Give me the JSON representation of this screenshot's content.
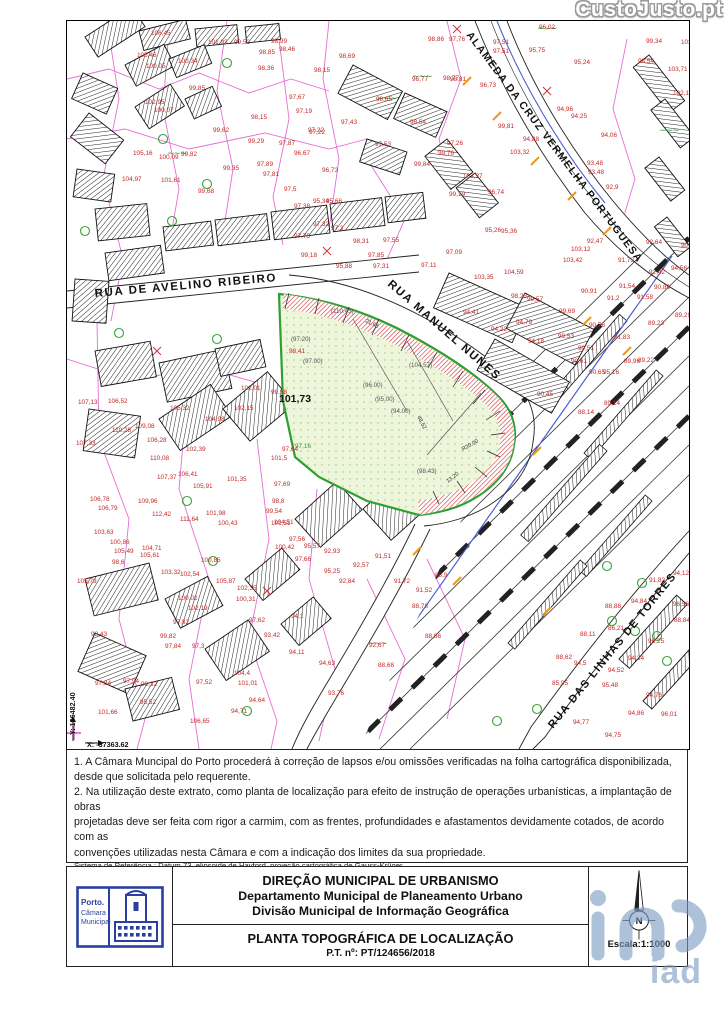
{
  "watermarks": {
    "top": "CustoJusto.pt",
    "bottom": "iad"
  },
  "map": {
    "streets": [
      {
        "label": "RUA DE AVELINO RIBEIRO",
        "x": 28,
        "y": 276,
        "rot": -5,
        "fs": 11.5,
        "ls": 1.6
      },
      {
        "label": "RUA MANUEL NUNES",
        "x": 320,
        "y": 264,
        "rot": 41,
        "fs": 11.5,
        "ls": 1.6
      },
      {
        "label": "ALAMEDA DA CRUZ VERMELHA PORTUGUESA",
        "x": 399,
        "y": 14,
        "rot": 53,
        "fs": 10.5,
        "ls": 1.3
      },
      {
        "label": "RUA DAS LINHAS DE TORRES",
        "x": 486,
        "y": 708,
        "rot": -51,
        "fs": 11,
        "ls": 1.5
      }
    ],
    "corner": {
      "y_label": "Y: 166482.40",
      "x_label": "X: -37363.62"
    },
    "parcel_labels": [
      {
        "x": 264,
        "y": 292,
        "v": "(110.43)",
        "c": "dim"
      },
      {
        "x": 224,
        "y": 320,
        "v": "(97.20)",
        "c": "dim"
      },
      {
        "x": 236,
        "y": 342,
        "v": "(97.00)",
        "c": "dim"
      },
      {
        "x": 296,
        "y": 366,
        "v": "(96.00)",
        "c": "dim"
      },
      {
        "x": 308,
        "y": 380,
        "v": "(95.00)",
        "c": "dim"
      },
      {
        "x": 324,
        "y": 392,
        "v": "(94.00)",
        "c": "dim"
      },
      {
        "x": 342,
        "y": 346,
        "v": "(104.57)",
        "c": "dim"
      },
      {
        "x": 212,
        "y": 381,
        "v": "101,73",
        "c": "bold"
      },
      {
        "x": 228,
        "y": 427,
        "v": "97,16",
        "c": "green"
      },
      {
        "x": 350,
        "y": 452,
        "v": "(98.43)",
        "c": "dim"
      }
    ],
    "dims": [
      {
        "x": 298,
        "y": 301,
        "v": "21.65",
        "rot": 26
      },
      {
        "x": 350,
        "y": 396,
        "v": "48.52",
        "rot": 62
      },
      {
        "x": 381,
        "y": 462,
        "v": "13.20",
        "rot": -38
      },
      {
        "x": 396,
        "y": 430,
        "v": "R20.00",
        "rot": -30
      }
    ],
    "points": [
      [
        84,
        14,
        "106,45"
      ],
      [
        70,
        36,
        "105,46"
      ],
      [
        79,
        47,
        "100,05"
      ],
      [
        111,
        42,
        "100,34"
      ],
      [
        141,
        23,
        "101,93"
      ],
      [
        167,
        23,
        "99,52"
      ],
      [
        204,
        22,
        "98,99"
      ],
      [
        212,
        30,
        "98,46"
      ],
      [
        192,
        33,
        "98,85"
      ],
      [
        272,
        37,
        "98,69"
      ],
      [
        247,
        51,
        "98,15"
      ],
      [
        191,
        49,
        "98,36"
      ],
      [
        122,
        69,
        "99,85"
      ],
      [
        222,
        78,
        "97,67"
      ],
      [
        229,
        92,
        "97,19"
      ],
      [
        274,
        103,
        "97,43"
      ],
      [
        241,
        111,
        "97,22"
      ],
      [
        184,
        98,
        "98,15"
      ],
      [
        146,
        111,
        "99,62"
      ],
      [
        181,
        122,
        "99,29"
      ],
      [
        212,
        124,
        "97,87"
      ],
      [
        227,
        134,
        "96,67"
      ],
      [
        66,
        134,
        "105,16"
      ],
      [
        92,
        138,
        "100,09"
      ],
      [
        114,
        135,
        "99,82"
      ],
      [
        156,
        149,
        "99,35"
      ],
      [
        190,
        145,
        "97,89"
      ],
      [
        196,
        155,
        "97,81"
      ],
      [
        255,
        151,
        "96,73"
      ],
      [
        55,
        160,
        "104,97"
      ],
      [
        94,
        161,
        "101,61"
      ],
      [
        131,
        172,
        "99,68"
      ],
      [
        217,
        170,
        "97,5"
      ],
      [
        78,
        83,
        "102,95"
      ],
      [
        87,
        91,
        "100,07"
      ],
      [
        361,
        20,
        "98,86"
      ],
      [
        382,
        20,
        "97,76"
      ],
      [
        426,
        23,
        "97,51"
      ],
      [
        426,
        32,
        "97,51"
      ],
      [
        472,
        8,
        "96,02"
      ],
      [
        462,
        31,
        "95,75"
      ],
      [
        507,
        43,
        "95,24"
      ],
      [
        579,
        22,
        "99,34"
      ],
      [
        614,
        23,
        "103,7"
      ],
      [
        571,
        42,
        "98,54"
      ],
      [
        601,
        50,
        "103,71"
      ],
      [
        376,
        59,
        "98,77"
      ],
      [
        345,
        60,
        "96,77"
      ],
      [
        383,
        60,
        "98,81"
      ],
      [
        413,
        66,
        "96,73"
      ],
      [
        309,
        80,
        "98,65"
      ],
      [
        606,
        74,
        "102,18"
      ],
      [
        343,
        103,
        "98,54"
      ],
      [
        490,
        90,
        "94,96"
      ],
      [
        504,
        97,
        "94,25"
      ],
      [
        431,
        107,
        "99,81"
      ],
      [
        308,
        125,
        "97,53"
      ],
      [
        380,
        124,
        "97,26"
      ],
      [
        456,
        120,
        "94,88"
      ],
      [
        534,
        116,
        "94,06"
      ],
      [
        443,
        133,
        "103,32"
      ],
      [
        371,
        134,
        "99,76"
      ],
      [
        520,
        144,
        "93,48"
      ],
      [
        521,
        153,
        "93,48"
      ],
      [
        421,
        173,
        "96,74"
      ],
      [
        539,
        168,
        "92,9"
      ],
      [
        242,
        113,
        "97,22"
      ],
      [
        347,
        145,
        "99,84"
      ],
      [
        246,
        182,
        "95,34"
      ],
      [
        259,
        182,
        "95,66"
      ],
      [
        396,
        157,
        "103,27"
      ],
      [
        227,
        187,
        "97,38"
      ],
      [
        382,
        175,
        "99,19"
      ],
      [
        246,
        205,
        "97,32"
      ],
      [
        264,
        209,
        "97,3"
      ],
      [
        227,
        217,
        "97,75"
      ],
      [
        286,
        222,
        "98,31"
      ],
      [
        316,
        221,
        "97,55"
      ],
      [
        234,
        236,
        "99,18"
      ],
      [
        301,
        236,
        "97,85"
      ],
      [
        418,
        211,
        "95,26"
      ],
      [
        379,
        233,
        "97,09"
      ],
      [
        354,
        246,
        "97,11"
      ],
      [
        269,
        247,
        "95,88"
      ],
      [
        306,
        247,
        "97,31"
      ],
      [
        496,
        241,
        "103,42"
      ],
      [
        437,
        253,
        "104,59"
      ],
      [
        407,
        258,
        "103,35"
      ],
      [
        444,
        277,
        "98,23"
      ],
      [
        514,
        272,
        "90,91"
      ],
      [
        460,
        280,
        "99,57"
      ],
      [
        492,
        292,
        "99,69"
      ],
      [
        396,
        293,
        "94,41"
      ],
      [
        424,
        310,
        "94,22"
      ],
      [
        449,
        303,
        "94,79"
      ],
      [
        461,
        322,
        "94,18"
      ],
      [
        491,
        317,
        "99,53"
      ],
      [
        522,
        306,
        "90,76"
      ],
      [
        511,
        329,
        "90,51"
      ],
      [
        504,
        342,
        "90,61"
      ],
      [
        520,
        222,
        "92,47"
      ],
      [
        614,
        226,
        "90,47"
      ],
      [
        579,
        223,
        "92,64"
      ],
      [
        551,
        241,
        "91,73"
      ],
      [
        582,
        253,
        "92,42"
      ],
      [
        604,
        249,
        "94,56"
      ],
      [
        552,
        267,
        "91,54"
      ],
      [
        570,
        278,
        "91,58"
      ],
      [
        587,
        268,
        "90,86"
      ],
      [
        540,
        279,
        "91,2"
      ],
      [
        581,
        304,
        "89,23"
      ],
      [
        608,
        296,
        "89,29"
      ],
      [
        547,
        318,
        "91,83"
      ],
      [
        522,
        353,
        "90,65"
      ],
      [
        536,
        353,
        "95,16"
      ],
      [
        571,
        341,
        "89,22"
      ],
      [
        557,
        342,
        "89,96"
      ],
      [
        470,
        375,
        "90,45"
      ],
      [
        537,
        384,
        "89,14"
      ],
      [
        511,
        393,
        "88,14"
      ],
      [
        504,
        230,
        "103,12"
      ],
      [
        434,
        212,
        "95,36"
      ],
      [
        215,
        430,
        "97,64"
      ],
      [
        207,
        503,
        "104,51"
      ],
      [
        222,
        520,
        "97,56"
      ],
      [
        208,
        528,
        "100,42"
      ],
      [
        237,
        527,
        "95,57"
      ],
      [
        257,
        532,
        "92,93"
      ],
      [
        94,
        553,
        "103,32"
      ],
      [
        113,
        555,
        "102,54"
      ],
      [
        134,
        541,
        "100,85"
      ],
      [
        308,
        537,
        "91,51"
      ],
      [
        327,
        562,
        "91,72"
      ],
      [
        286,
        546,
        "92,57"
      ],
      [
        228,
        540,
        "97,66"
      ],
      [
        257,
        552,
        "95,25"
      ],
      [
        272,
        562,
        "92,84"
      ],
      [
        349,
        571,
        "91,52"
      ],
      [
        345,
        587,
        "88,78"
      ],
      [
        368,
        556,
        "88,9"
      ],
      [
        149,
        562,
        "105,87"
      ],
      [
        170,
        569,
        "102,35"
      ],
      [
        169,
        580,
        "100,31"
      ],
      [
        121,
        589,
        "102,19"
      ],
      [
        111,
        579,
        "100,02"
      ],
      [
        182,
        601,
        "97,62"
      ],
      [
        224,
        597,
        "94,1"
      ],
      [
        106,
        603,
        "97,82"
      ],
      [
        93,
        617,
        "99,82"
      ],
      [
        98,
        627,
        "97,84"
      ],
      [
        125,
        627,
        "97,3"
      ],
      [
        197,
        616,
        "93,42"
      ],
      [
        222,
        633,
        "94,11"
      ],
      [
        252,
        644,
        "94,63"
      ],
      [
        311,
        646,
        "88,68"
      ],
      [
        261,
        674,
        "93,76"
      ],
      [
        129,
        663,
        "97,52"
      ],
      [
        167,
        654,
        "104,4"
      ],
      [
        171,
        664,
        "101,01"
      ],
      [
        182,
        681,
        "94,64"
      ],
      [
        164,
        692,
        "94,71"
      ],
      [
        123,
        702,
        "106,65"
      ],
      [
        358,
        617,
        "88,86"
      ],
      [
        302,
        626,
        "92,67"
      ],
      [
        606,
        554,
        "94,12"
      ],
      [
        582,
        561,
        "91,82"
      ],
      [
        564,
        582,
        "94,84"
      ],
      [
        538,
        587,
        "88,88"
      ],
      [
        606,
        585,
        "96,56"
      ],
      [
        607,
        601,
        "88,84"
      ],
      [
        541,
        609,
        "86,21"
      ],
      [
        513,
        615,
        "88,11"
      ],
      [
        507,
        644,
        "94,5"
      ],
      [
        489,
        638,
        "88,62"
      ],
      [
        581,
        622,
        "96,25"
      ],
      [
        485,
        664,
        "85,95"
      ],
      [
        561,
        639,
        "94,34"
      ],
      [
        541,
        651,
        "94,52"
      ],
      [
        535,
        666,
        "95,48"
      ],
      [
        579,
        676,
        "94,76"
      ],
      [
        561,
        694,
        "94,86"
      ],
      [
        594,
        695,
        "96,01"
      ],
      [
        506,
        703,
        "94,77"
      ],
      [
        538,
        716,
        "94,75"
      ],
      [
        28,
        664,
        "97,84"
      ],
      [
        56,
        662,
        "97,94"
      ],
      [
        74,
        665,
        "98,32"
      ],
      [
        73,
        683,
        "95,52"
      ],
      [
        31,
        693,
        "101,66"
      ],
      [
        10,
        562,
        "105,79"
      ],
      [
        24,
        615,
        "98,43"
      ],
      [
        45,
        543,
        "98,6"
      ],
      [
        47,
        532,
        "105,49"
      ],
      [
        43,
        523,
        "100,86"
      ],
      [
        75,
        529,
        "104,71"
      ],
      [
        73,
        536,
        "105,61"
      ],
      [
        103,
        389,
        "105,32"
      ],
      [
        138,
        400,
        "104,98"
      ],
      [
        45,
        411,
        "110,28"
      ],
      [
        68,
        407,
        "109,08"
      ],
      [
        9,
        424,
        "107,33"
      ],
      [
        80,
        421,
        "106,28"
      ],
      [
        119,
        430,
        "102,39"
      ],
      [
        83,
        439,
        "110,08"
      ],
      [
        111,
        455,
        "106,41"
      ],
      [
        90,
        458,
        "107,37"
      ],
      [
        126,
        467,
        "105,91"
      ],
      [
        71,
        482,
        "109,96"
      ],
      [
        23,
        480,
        "106,78"
      ],
      [
        31,
        489,
        "106,79"
      ],
      [
        85,
        495,
        "112,42"
      ],
      [
        113,
        500,
        "111,64"
      ],
      [
        139,
        494,
        "101,98"
      ],
      [
        151,
        504,
        "100,43"
      ],
      [
        27,
        513,
        "103,63"
      ],
      [
        204,
        504,
        "101,51"
      ],
      [
        199,
        492,
        "99,54"
      ],
      [
        205,
        482,
        "98,8"
      ],
      [
        174,
        369,
        "102,01"
      ],
      [
        204,
        373,
        "99,58"
      ],
      [
        11,
        383,
        "107,13"
      ],
      [
        41,
        382,
        "106,52"
      ],
      [
        167,
        389,
        "102,15"
      ],
      [
        204,
        439,
        "101,5"
      ],
      [
        160,
        460,
        "101,35"
      ],
      [
        207,
        465,
        "97,69"
      ],
      [
        222,
        332,
        "98,41"
      ]
    ]
  },
  "notes": {
    "l1": "1. A Câmara Muncipal do Porto procederá à correção de lapsos e/ou omissões verificadas na folha cartográfica disponibilizada,",
    "l2": "desde que solicitada pelo requerente.",
    "l3": "2. Na utilização deste extrato, como planta de localização para efeito de instrução de operações urbanísticas, a implantação de obras",
    "l4": "projetadas deve ser feita com rigor a carmim, com as frentes, profundidades e afastamentos devidamente cotados, de acordo com as",
    "l5": "convenções utilizadas nesta Câmara e com a indicação dos limites da sua propriedade.",
    "ref1": "Sistema de Referência : Datum 73, elipsoide de Hayford, projeção cartográfica de Gauss-Krüger",
    "ref2": "com ponto origem no vértice geodésico da Melriça TF4",
    "cl": "C. L. 1992 -",
    "date": "06-07-2021"
  },
  "footer": {
    "org1": "DIREÇÃO MUNICIPAL DE URBANISMO",
    "org2": "Departamento Municipal de Planeamento Urbano",
    "org3": "Divisão Municipal de Informação Geográfica",
    "title": "PLANTA TOPOGRÁFICA DE LOCALIZAÇÃO",
    "pt": "P.T. nº: PT/124656/2018",
    "escala": "Escala:1:1000",
    "north": "N",
    "logo": {
      "t1": "Porto.",
      "t2": "Câmara",
      "t3": "Municipal"
    }
  },
  "colors": {
    "carmim": "#cf3333",
    "parcel_green": "#2f9e33",
    "cadastral_magenta": "#e55ecf",
    "logo_blue": "#2a3f9f",
    "watermark_blue": "#7b9cc2",
    "elevation_red": "#c22726"
  }
}
